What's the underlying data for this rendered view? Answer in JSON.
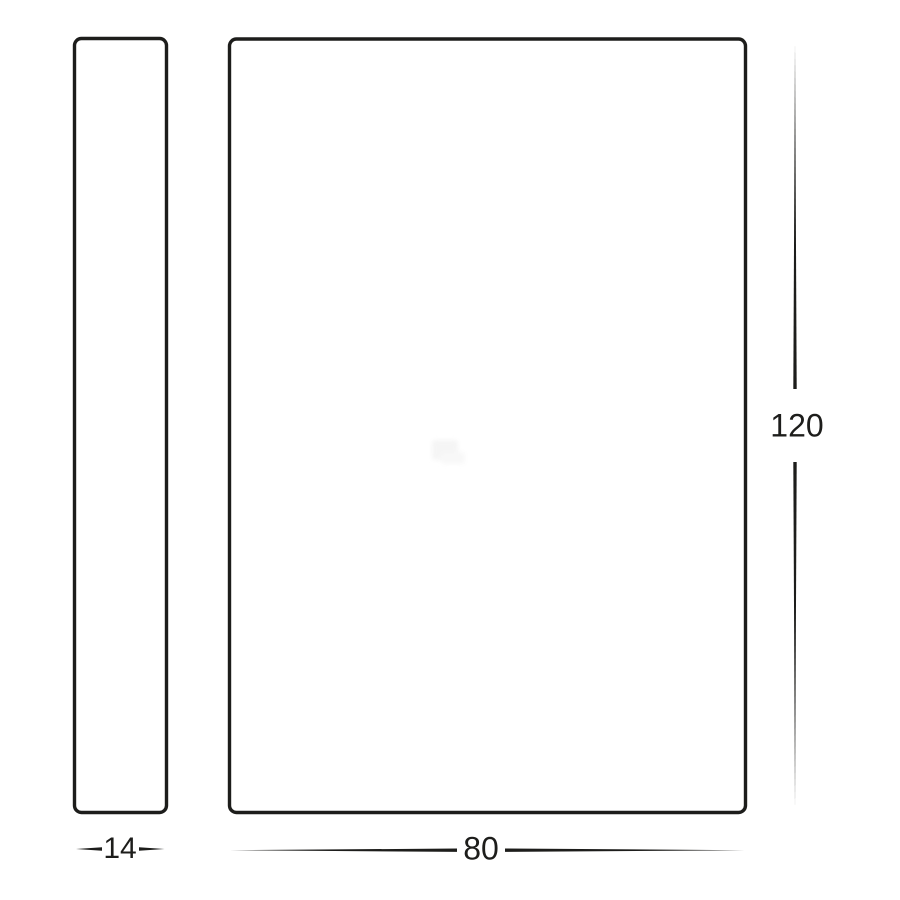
{
  "diagram": {
    "type": "technical-dimension-drawing",
    "dimensions": {
      "depth": {
        "label": "14",
        "value": 14
      },
      "width": {
        "label": "80",
        "value": 80
      },
      "height": {
        "label": "120",
        "value": 120
      }
    },
    "colors": {
      "line": "#1d1d1b",
      "text": "#1d1d1b",
      "background": "#ffffff",
      "watermark": "#f2f2f2"
    }
  }
}
